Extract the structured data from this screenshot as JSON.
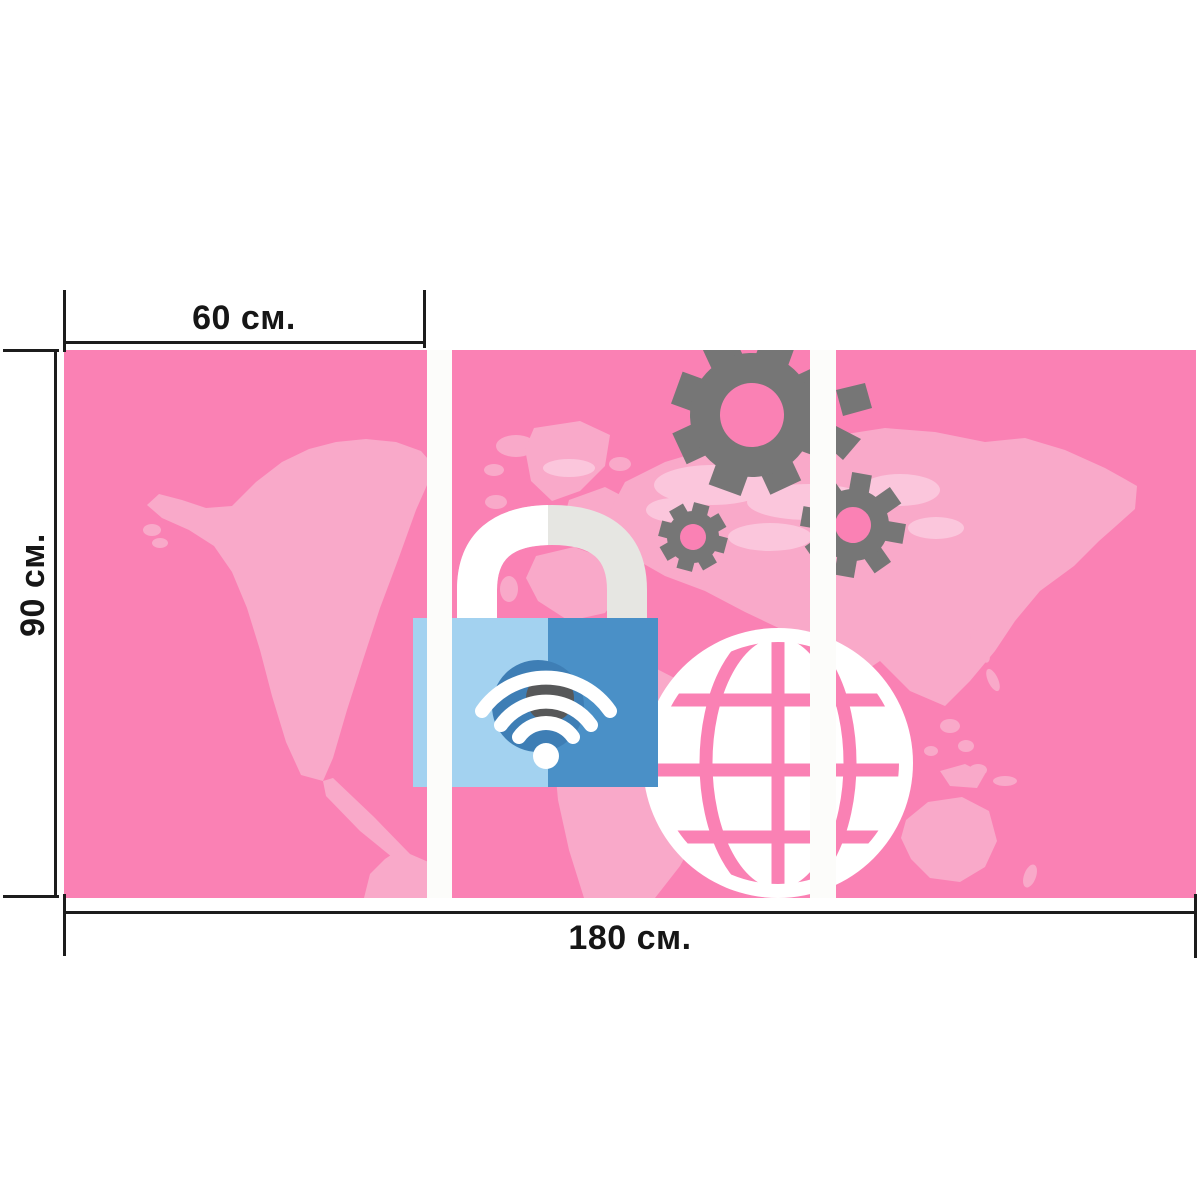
{
  "product": {
    "type_note": "three-panel wall-art mockup",
    "panel_count": 3
  },
  "dimensions": {
    "top": "60 см.",
    "side": "90 см.",
    "bottom": "180 см."
  },
  "artwork_icons": [
    "world-map",
    "padlock-icon",
    "wifi-icon",
    "globe-icon",
    "gear-icon-large",
    "gear-icon-small",
    "gear-icon-medium",
    "gear-fragment"
  ],
  "colors": {
    "bg_pink": "#FA81B4",
    "map_pink": "#F9A9C9",
    "map_light_pink": "#FBC6DC",
    "gear_gray": "#767676",
    "lock_blue_light": "#A3D2F0",
    "lock_blue_dark": "#4A90C7",
    "shackle_white": "#FFFFFF",
    "shackle_gray": "#E6E6E2",
    "wifi_white": "#FFFFFF",
    "wifi_shadow_blue": "#3E7EB5",
    "wifi_shadow_gray": "#575859",
    "gap_white": "#FCFCFA",
    "line_black": "#1C1C1C",
    "page_bg": "#FFFFFF",
    "label_color": "#161616"
  }
}
